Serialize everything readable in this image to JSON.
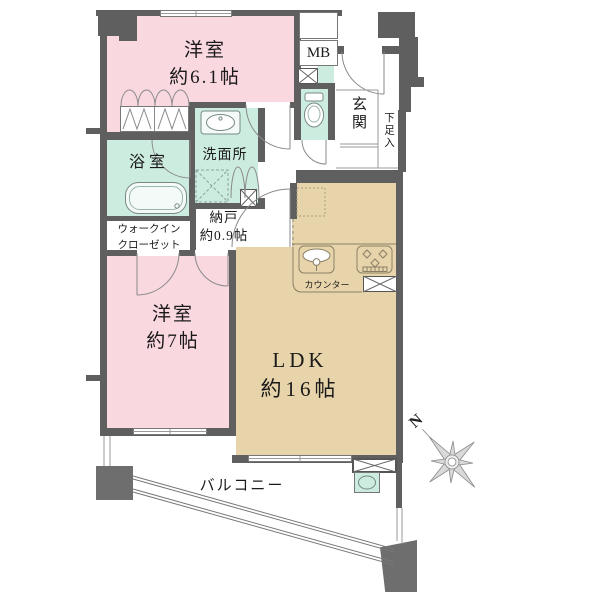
{
  "floorplan": {
    "compass_label": "N",
    "rooms": {
      "bedroom_61": {
        "name": "洋室",
        "size": "約6.1帖"
      },
      "bedroom_7": {
        "name": "洋室",
        "size": "約7帖"
      },
      "ldk": {
        "name": "LDK",
        "size": "約16帖"
      },
      "nando": {
        "name": "納戸",
        "size": "約0.9帖"
      },
      "bathroom": {
        "name": "浴室"
      },
      "washroom": {
        "name": "洗面所"
      },
      "walk_in_closet": {
        "line1": "ウォークイン",
        "line2": "クローゼット"
      },
      "entrance": {
        "name": "玄関"
      },
      "shoe_cabinet": {
        "name": "下足入"
      },
      "meter_box": {
        "name": "MB"
      },
      "balcony": {
        "name": "バルコニー"
      },
      "kitchen_counter": {
        "name": "カウンター"
      }
    },
    "colors": {
      "bedroom_fill": "#f9d8e0",
      "wet_area_fill": "#cdece0",
      "ldk_fill": "#e8d4aa",
      "wall": "#5f5f5f"
    }
  }
}
